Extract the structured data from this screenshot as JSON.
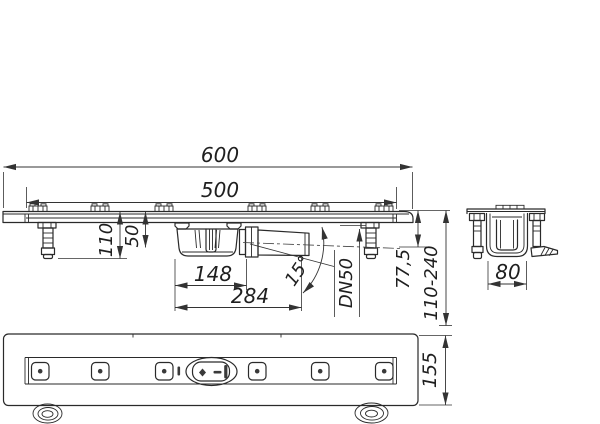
{
  "drawing": {
    "type": "technical-drawing-shower-channel-drain",
    "dims": {
      "overall_length": "600",
      "channel_length": "500",
      "install_height": "110",
      "channel_depth": "50",
      "trap_length": "148",
      "outlet_projection": "284",
      "outlet_angle": "15°",
      "pipe_size": "DN50",
      "flange_height": "77,5",
      "adjust_range": "110-240",
      "section_width": "80",
      "body_width": "155"
    },
    "colors": {
      "line": "#2a2a2a",
      "dimension": "#333333",
      "text": "#1f1f1f",
      "background": "#ffffff"
    }
  }
}
